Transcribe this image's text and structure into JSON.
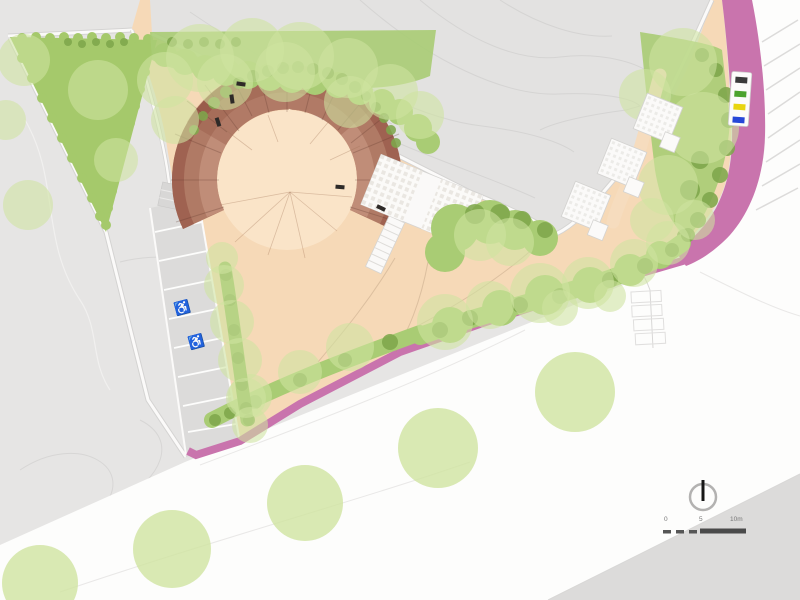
{
  "colors": {
    "bg": "#e6e5e4",
    "parcel": "#e3e2e1",
    "contour": "#d5d4d3",
    "road": "#fdfdfc",
    "road_gray": "#dcdbda",
    "beige": "#f6d9b7",
    "beige_light": "#fae4c8",
    "pink": "#c974ad",
    "brown": "#b07a65",
    "brown_dark": "#9b5d4c",
    "brown_deep": "#8e4f3e",
    "brown_light": "#c89680",
    "green_light": "#cfe3a0",
    "green_mid": "#a9cc74",
    "green_dark": "#7fa74c",
    "hedge_green": "#a5c96b",
    "path_white": "#fbfaf9",
    "bench_dark": "#2e2a28",
    "bin_black": "#3a3a3a",
    "bin_green": "#4ca32e",
    "bin_yellow": "#e8d50f",
    "bin_blue": "#2747d8"
  },
  "scale_bar": {
    "labels": [
      "0",
      "5",
      "10m"
    ]
  },
  "icons": {
    "wheelchair": "♿",
    "north_arrow": "needle-in-circle"
  }
}
